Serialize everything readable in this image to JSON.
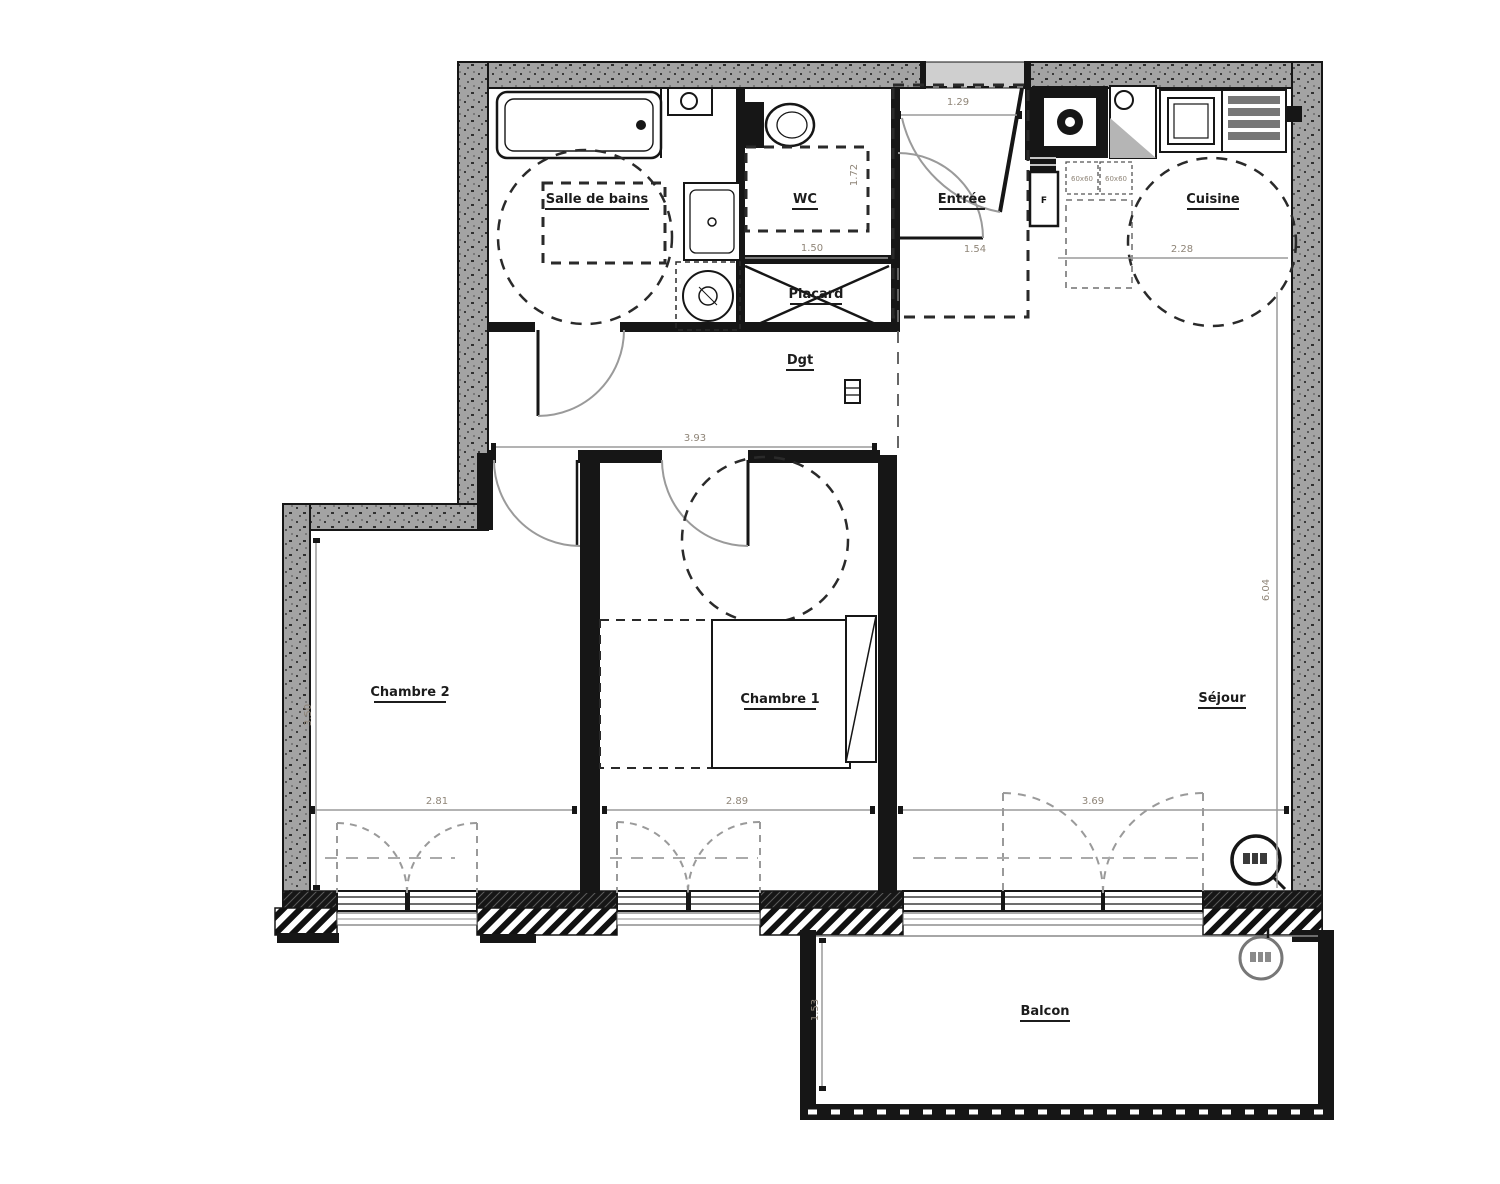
{
  "plan": {
    "rooms": {
      "salle_de_bains": {
        "label": "Salle de bains"
      },
      "wc": {
        "label": "WC",
        "width": "1.50",
        "depth": "1.72"
      },
      "entree": {
        "label": "Entrée",
        "width": "1.54",
        "door_clearance": "1.29"
      },
      "cuisine": {
        "label": "Cuisine",
        "width": "2.28"
      },
      "placard": {
        "label": "Placard"
      },
      "dgt": {
        "label": "Dgt",
        "length": "3.93"
      },
      "chambre_2": {
        "label": "Chambre 2",
        "width": "2.81",
        "depth": "3.50"
      },
      "chambre_1": {
        "label": "Chambre 1",
        "width": "2.89"
      },
      "sejour": {
        "label": "Séjour",
        "width": "3.69",
        "depth": "6.04"
      },
      "balcon": {
        "label": "Balcon",
        "depth": "1.53"
      }
    },
    "kitchen": {
      "fridge_label": "F",
      "appliance_size_1": "60x60",
      "appliance_size_2": "60x60"
    },
    "colors": {
      "wall_fill": "#a3a3a3",
      "line": "#161616",
      "dimension_text": "#8f8578"
    }
  }
}
